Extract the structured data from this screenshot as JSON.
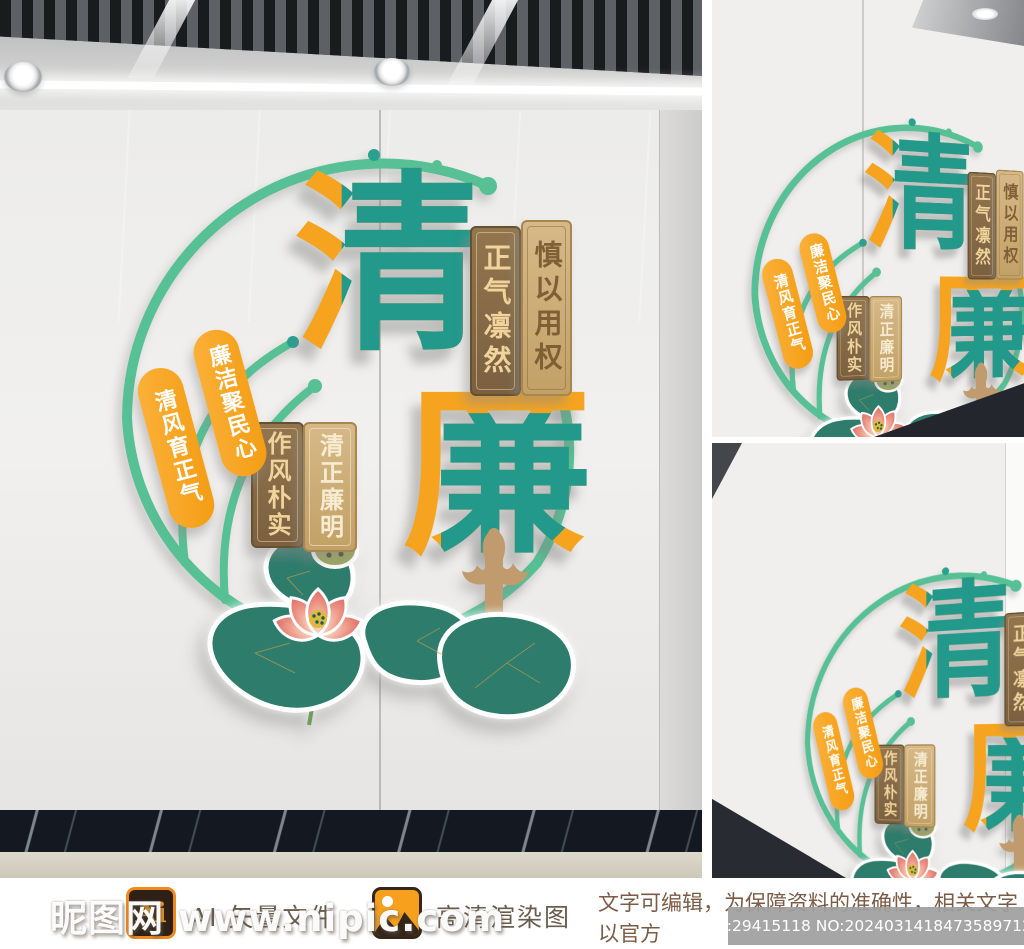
{
  "artwork": {
    "title_char_qing": "清",
    "title_char_lian": "廉",
    "plaques": {
      "zhengqi_linran": "正气凛然",
      "shen_yi_yong_quan": "慎以用权",
      "lianjie_ju_minxin": "廉洁聚民心",
      "qingfeng_yu_zhengqi": "清风育正气",
      "zuofeng_pushi": "作风朴实",
      "qingzheng_lianming": "清正廉明"
    },
    "colors": {
      "teal": "#22998b",
      "orange": "#f6a41f",
      "mint_ring": "#57c095",
      "plaque_dark_brown": "#7a6040",
      "plaque_tan": "#c2a166",
      "pill_orange": "#f49c12",
      "leaf_green": "#2e7c6b",
      "flower_pink": "#e2766e",
      "column_tan": "#c09b6d"
    }
  },
  "footer": {
    "ai_badge": "Ai",
    "ai_label": "AI 矢量文件",
    "render_label": "高清渲染图",
    "notice_line1": "文字可编辑，为保障资料的准确性，相关文字以官方",
    "notice_line2": "发布为准，请根据需要自行至官网获取！",
    "id_badge": "ID:29415118 NO:20240314184735897128"
  },
  "watermark": {
    "text": "昵图网 www.nipic.com"
  }
}
